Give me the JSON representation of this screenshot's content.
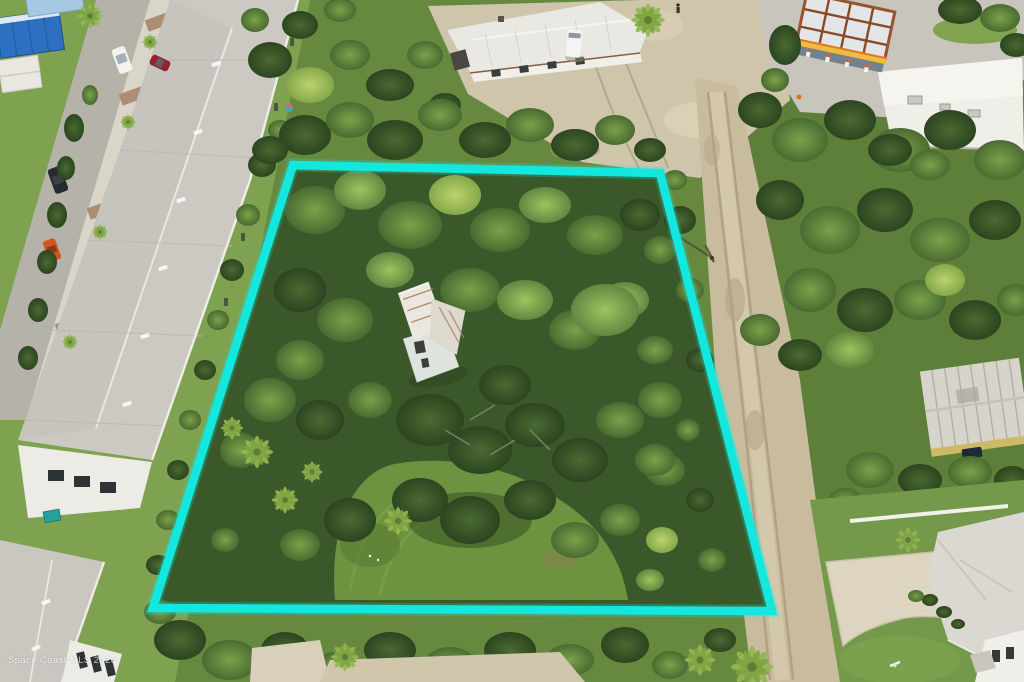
{
  "photo": {
    "kind": "aerial-drone-photo",
    "description": "Aerial view of a wooded vacant residential lot outlined with a cyan property boundary, flanked by a townhome complex street on the left, a gas station and white commercial building at top right, a sandy dirt road along the right side, and single-family homes at the edges."
  },
  "watermark": {
    "text": "Space Coast MLS 2020",
    "color": "#ffffff"
  },
  "boundary": {
    "label": "property-boundary",
    "color": "#14E7DE",
    "corners": [
      [
        293,
        165
      ],
      [
        660,
        173
      ],
      [
        772,
        611
      ],
      [
        153,
        608
      ]
    ]
  },
  "scene": {
    "elements": [
      "townhome-roofs",
      "residential-street",
      "sidewalk",
      "parked-white-car",
      "parked-red-car",
      "parked-dark-car",
      "parked-orange-car",
      "blue-commercial-building",
      "white-sheds",
      "white-metal-roof-building",
      "white-van",
      "sandy-parking-area",
      "gas-station-canopy",
      "fuel-pumps",
      "convenience-store",
      "dirt-road",
      "utility-pole",
      "wooded-lot",
      "derelict-white-house",
      "grass-clearing",
      "palm-trees",
      "weathered-roof-house",
      "house-with-concrete-driveway",
      "white-fence",
      "mailbox",
      "teal-dumpster",
      "pedestrian"
    ]
  }
}
